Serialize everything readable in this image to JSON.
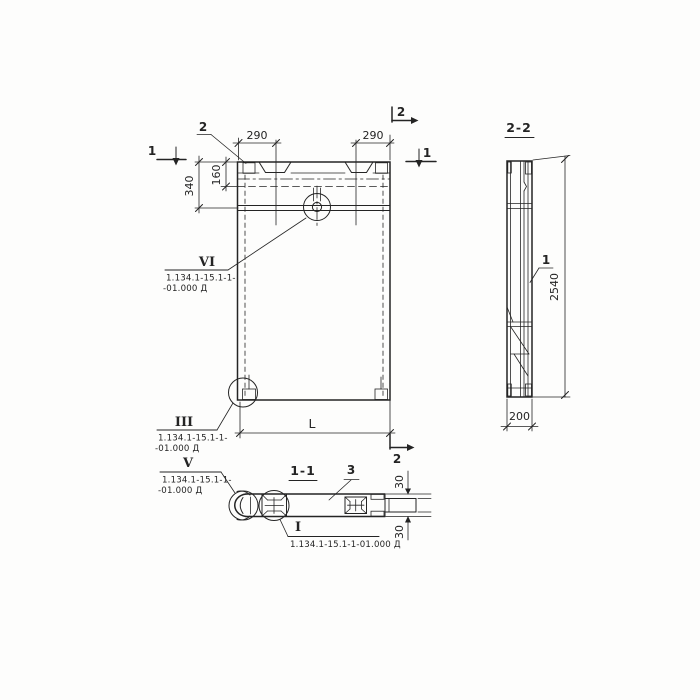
{
  "colors": {
    "ink": "#242424",
    "paper": "#fdfdfc"
  },
  "front_view": {
    "section1_left": "1",
    "section1_right": "1",
    "section2_top": "2",
    "section2_bottom": "2",
    "pos2_label": "2",
    "dim_290_left": "290",
    "dim_290_right": "290",
    "dim_340": "340",
    "dim_160": "160",
    "dim_length": "L",
    "detail_vi": {
      "numeral": "VI",
      "ref1": "1.134.1-15.1-1-",
      "ref2": "-01.000 Д"
    },
    "detail_iii": {
      "numeral": "III",
      "ref1": "1.134.1-15.1-1-",
      "ref2": "-01.000 Д"
    }
  },
  "side_view": {
    "label": "2-2",
    "pos1_label": "1",
    "dim_2540": "2540",
    "dim_200": "200"
  },
  "plan_view": {
    "label": "1-1",
    "pos3_label": "3",
    "dim_30_top": "30",
    "dim_30_bottom": "30",
    "detail_v": {
      "numeral": "V",
      "ref1": "1.134.1-15.1-1-",
      "ref2": "-01.000 Д"
    },
    "detail_i": {
      "numeral": "I",
      "ref": "1.134.1-15.1-1-01.000 Д"
    }
  }
}
